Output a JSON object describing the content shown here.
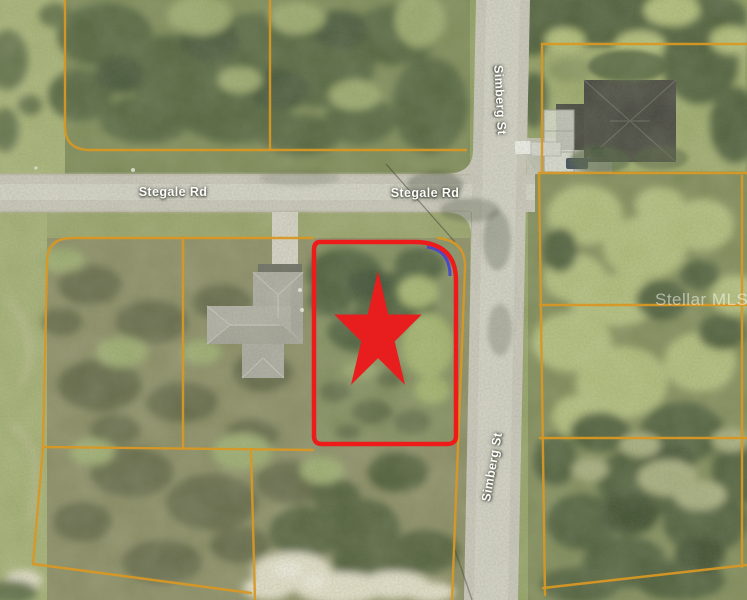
{
  "map": {
    "type": "aerial-parcel-map",
    "road_labels": [
      {
        "id": "stegale-west",
        "text": "Stegale Rd"
      },
      {
        "id": "stegale-east",
        "text": "Stegale Rd"
      },
      {
        "id": "simberg-north",
        "text": "Simberg St"
      },
      {
        "id": "simberg-south",
        "text": "Simberg St"
      }
    ],
    "watermark": "Stellar MLS",
    "marker": {
      "icon": "star-icon",
      "meaning": "subject-property-location"
    },
    "colors": {
      "parcel_boundary_orange": "#d89825",
      "subject_outline_red": "#ee1b1b",
      "subject_star_red": "#e81d1d",
      "adjacent_boundary_blue": "#4643d0",
      "road_label_text": "#fdfdfa",
      "watermark_text": "rgba(255,255,255,0.5)"
    }
  }
}
